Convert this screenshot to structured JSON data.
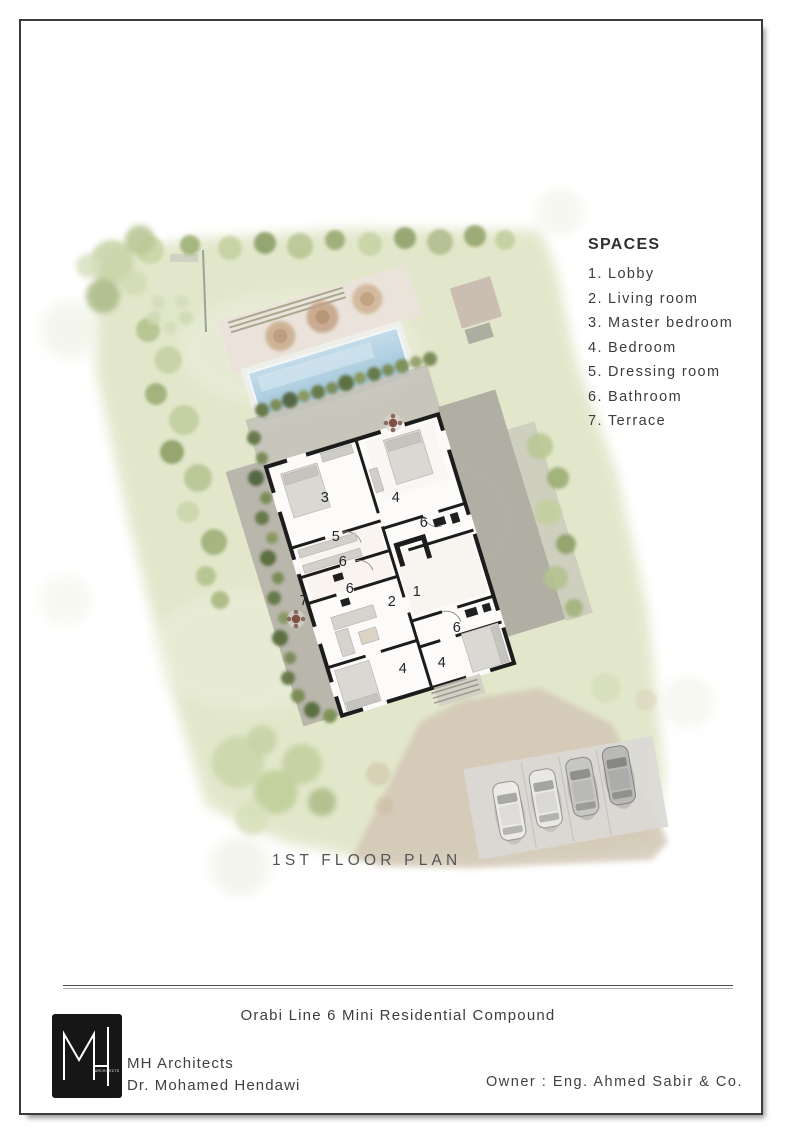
{
  "spaces": {
    "heading": "SPACES",
    "items": [
      {
        "num": "1.",
        "label": "Lobby"
      },
      {
        "num": "2.",
        "label": "Living room"
      },
      {
        "num": "3.",
        "label": "Master bedroom"
      },
      {
        "num": "4.",
        "label": "Bedroom"
      },
      {
        "num": "5.",
        "label": "Dressing room"
      },
      {
        "num": "6.",
        "label": "Bathroom"
      },
      {
        "num": "7.",
        "label": "Terrace"
      }
    ]
  },
  "plan": {
    "caption": "1ST FLOOR PLAN",
    "room_labels": [
      "3",
      "4",
      "6",
      "5",
      "6",
      "6",
      "7",
      "2",
      "1",
      "6",
      "4",
      "4"
    ]
  },
  "footer": {
    "project": "Orabi Line 6 Mini Residential Compound",
    "firm": "MH Architects",
    "architect": "Dr. Mohamed Hendawi",
    "owner": "Owner : Eng. Ahmed Sabir & Co.",
    "logo_monogram": "MH",
    "logo_sub": "ARCHITECTS"
  },
  "colors": {
    "lawn": "#e1e6c9",
    "pool_water": "#aecfe1",
    "wall": "#1c1c1c",
    "paving": "#b6b3aa",
    "road": "#d2c5b4",
    "tree_dark": "#68794b",
    "tree_light": "#c3cf9f",
    "border": "#3c3c3c"
  }
}
